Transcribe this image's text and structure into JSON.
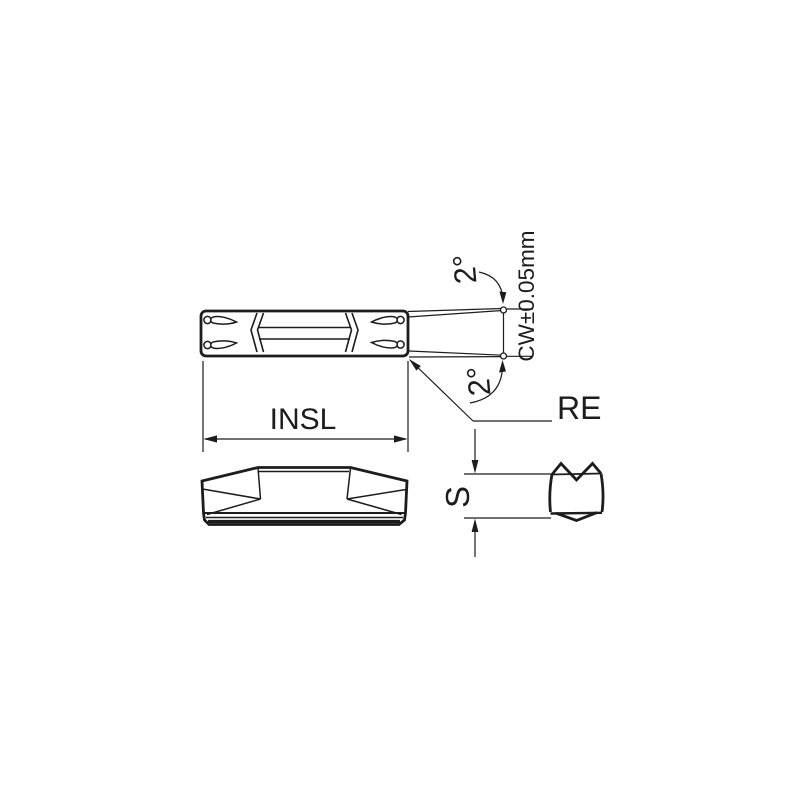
{
  "title": "Grooving insert technical drawing",
  "colors": {
    "background": "#ffffff",
    "line": "#1c1c1c"
  },
  "labels": {
    "insl": "INSL",
    "cw": "CW±0.05mm",
    "angle_top": "2°",
    "angle_bottom": "2°",
    "re": "RE",
    "s": "S"
  }
}
